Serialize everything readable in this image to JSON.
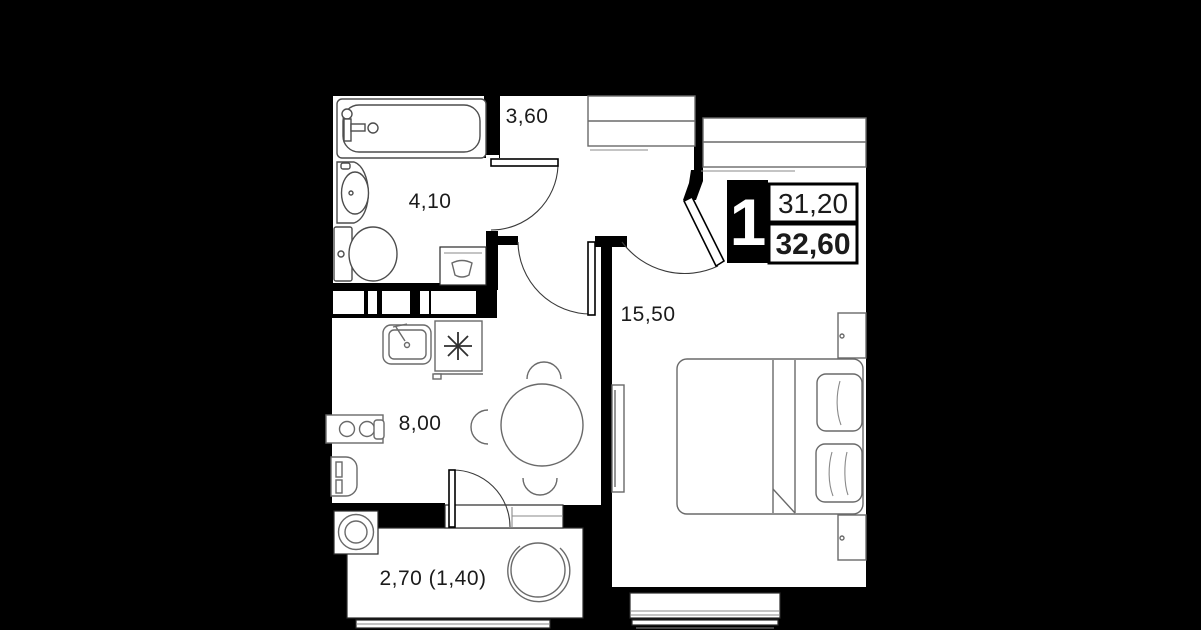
{
  "floorplan": {
    "title": "one-room apartment floor plan",
    "colors": {
      "background": "#000000",
      "walls": "#000000",
      "floor": "#ffffff",
      "furniture": "#6a6a6a",
      "text": "#1b1b1b"
    },
    "badge": {
      "rooms_count": "1",
      "living_area": "31,20",
      "total_area": "32,60"
    },
    "rooms": [
      {
        "id": "hallway",
        "area_label": "3,60"
      },
      {
        "id": "bathroom",
        "area_label": "4,10"
      },
      {
        "id": "bedroom",
        "area_label": "15,50"
      },
      {
        "id": "kitchen",
        "area_label": "8,00"
      },
      {
        "id": "balcony",
        "area_label": "2,70 (1,40)"
      }
    ],
    "icons": [
      "bathtub-icon",
      "sink-icon",
      "toilet-icon",
      "washing-machine-icon",
      "stove-burner-icon",
      "kitchen-sink-icon",
      "cooktop-icon",
      "fridge-icon",
      "dining-table-icon",
      "chair-icon",
      "bed-icon",
      "pillow-icon",
      "nightstand-icon",
      "tv-icon",
      "wardrobe-icon",
      "closet-icon",
      "door-arc-icon",
      "egg-chair-icon",
      "flower-pot-icon",
      "window-icon",
      "vent-shaft-icon"
    ]
  }
}
